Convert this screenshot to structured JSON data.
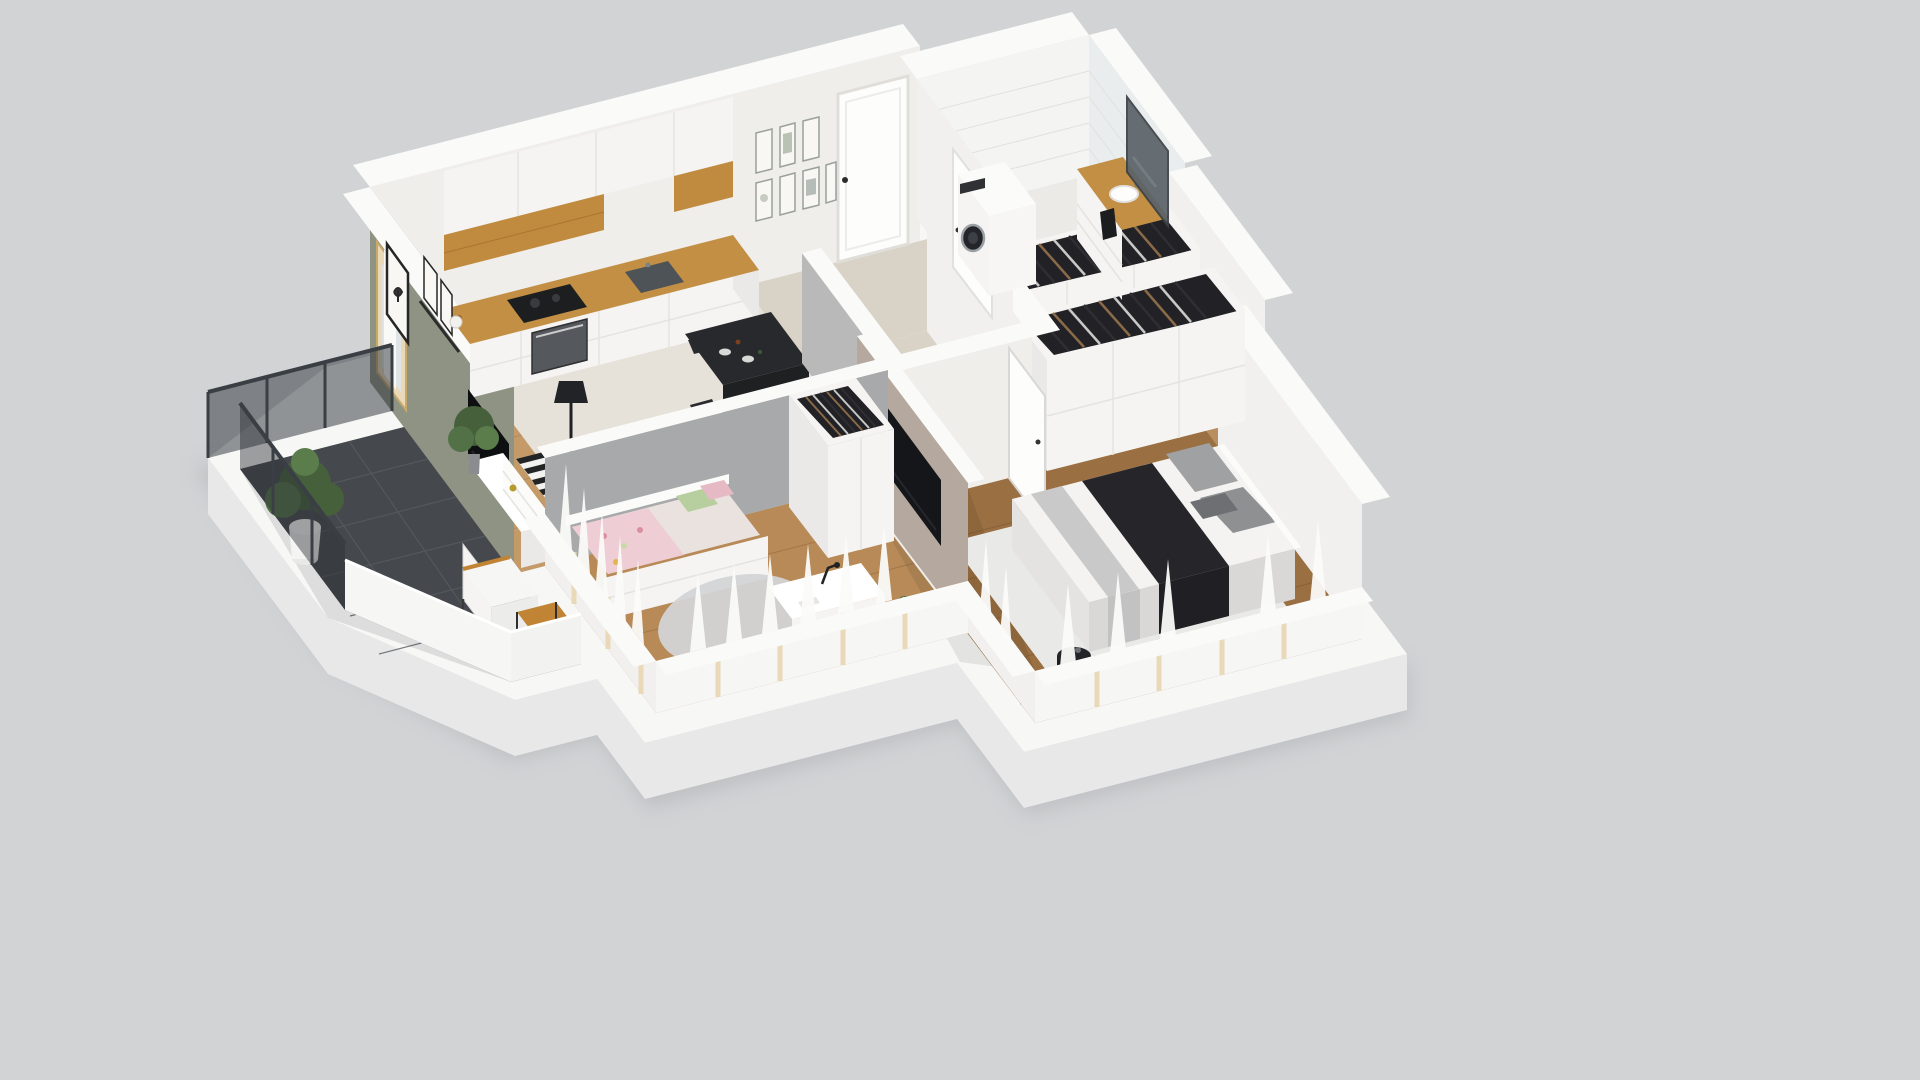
{
  "scene": {
    "type": "isometric-cutaway-3d-floorplan",
    "subject": "one-bedroom-plus-kids-room apartment render",
    "background_note": "render floats on plain light-grey studio backdrop, no visible text or UI controls"
  },
  "palette": {
    "background": "#d2d3d5",
    "ground_shadow": "#bcbdc0",
    "slab_top": "#f7f7f6",
    "slab_side": "#e8e8e9",
    "wall_white": "#f0eeeb",
    "wall_soft": "#f1f0ee",
    "wall_top": "#fafaf9",
    "wall_green": "#8e9384",
    "wall_grey": "#a8a9ab",
    "wall_taupe": "#b5a89e",
    "wall_light_grey": "#b9b9ba",
    "tile_wall": "#f4f5f3",
    "tile_wall_shaded": "#e9edee",
    "wood_living": "#c49a68",
    "wood_kids": "#b78a57",
    "wood_bedroom": "#9a6f42",
    "wood_closet": "#b98e5e",
    "plank_living": "#a87c4e",
    "plank_kids": "#96663a",
    "plank_bedroom": "#7c5530",
    "tile_kitchen": "#e7e2d9",
    "tile_hall": "#d9d3c7",
    "tile_bath": "#eceae6",
    "balcony_tile": "#4d5257",
    "cabinet_white": "#f5f4f2",
    "cabinet_side": "#eae9e7",
    "counter_oak": "#c28f45",
    "oak_accent": "#c08b3f",
    "appliance_dark": "#1d1e20",
    "oven_steel": "#55585c",
    "sink_dark": "#4e5357",
    "furniture_white": "#fbfbfa",
    "console_top": "#ffffff",
    "tv_black": "#0e0f11",
    "tv_screen": "#15161a",
    "rug_light": "#f2f2f0",
    "rug_stripe": "#232426",
    "table_black": "#28292c",
    "chair_black": "#2a2b2e",
    "lamp_black": "#222326",
    "daybed_mattress": "#e9e2df",
    "blanket_floral": "#efcdd4",
    "pillow_pink": "#e6bac4",
    "pillow_green": "#b7cf9e",
    "round_rug": "#d3d4d6",
    "bed_white": "#f4f3f1",
    "bed_base": "#d9d8d6",
    "bed_side": "#e4e3e1",
    "runner_grey": "#c9c9c9",
    "throw_dark": "#26262a",
    "pillow_light": "#9fa1a3",
    "pillow_mid": "#8e9092",
    "pillow_dark": "#6d6f72",
    "nightstand_black": "#232428",
    "closet_dark": "#222226",
    "clothes_brown": "#8a6a48",
    "clothes_light": "#c8c8c6",
    "clothes_dark": "#2e2e33",
    "glass": "#2a2f35",
    "railing_frame": "#3a3f45",
    "parapet": "#f6f6f5",
    "wood_outdoor": "#c08434",
    "wood_outdoor_side": "#a06c25",
    "plant_dark": "#45603a",
    "plant_mid": "#527146",
    "plant_light": "#5b7d4c",
    "pot_white": "#f4f4f2",
    "curtain": "#fbfbf9",
    "frame_wood": "#e9d9b8",
    "mirror": "#5a6268",
    "towel_black": "#1c1d1f",
    "door_white": "#fdfdfc",
    "art_paper": "#f8f7f3",
    "frame_black": "#262626",
    "white_rug": "#e9e9e7",
    "shadow_ink": "#000000"
  },
  "rooms": [
    {
      "id": "living-room",
      "floor": "oak wood",
      "features": [
        "sage green accent wall",
        "butterfly art frame",
        "picture ledge",
        "TV on white media console",
        "striped black-white rug",
        "black floor lamp",
        "black coffee table",
        "potted plant"
      ]
    },
    {
      "id": "kitchen",
      "floor": "beige tile",
      "features": [
        "white flat-front cabinets",
        "oak upper accent",
        "oak countertop",
        "induction hob",
        "built-in oven",
        "dark sink"
      ]
    },
    {
      "id": "dining-area",
      "floor": "beige tile",
      "features": [
        "black dining table",
        "black chairs",
        "tableware"
      ]
    },
    {
      "id": "hallway",
      "floor": "beige tile",
      "features": [
        "white entrance door",
        "gallery wall of seven botanical prints",
        "interior doors"
      ]
    },
    {
      "id": "bathroom",
      "floor": "light tile",
      "features": [
        "white subway-tile walls",
        "washing machine",
        "oak-top vanity",
        "vessel sink",
        "wall mirror",
        "black towel"
      ]
    },
    {
      "id": "walk-in-closet",
      "floor": "wood",
      "features": [
        "two open wardrobe rows filled with hanging clothes",
        "white panel fronts"
      ]
    },
    {
      "id": "main-bedroom",
      "floor": "dark wood",
      "features": [
        "double bed with grey pillows",
        "dark throw",
        "white shag rug",
        "round black nightstand",
        "wall-mounted TV on taupe wall"
      ]
    },
    {
      "id": "kids-room",
      "floor": "wood",
      "features": [
        "daybed with floral blanket and pink/green pillows",
        "round grey rug",
        "white desk with lamp",
        "white chair",
        "wardrobe with clothes"
      ]
    },
    {
      "id": "balcony",
      "floor": "dark grey tile",
      "features": [
        "glass railing",
        "white parapet",
        "potted plant",
        "outdoor chair with white cushion",
        "wood side table"
      ]
    }
  ]
}
